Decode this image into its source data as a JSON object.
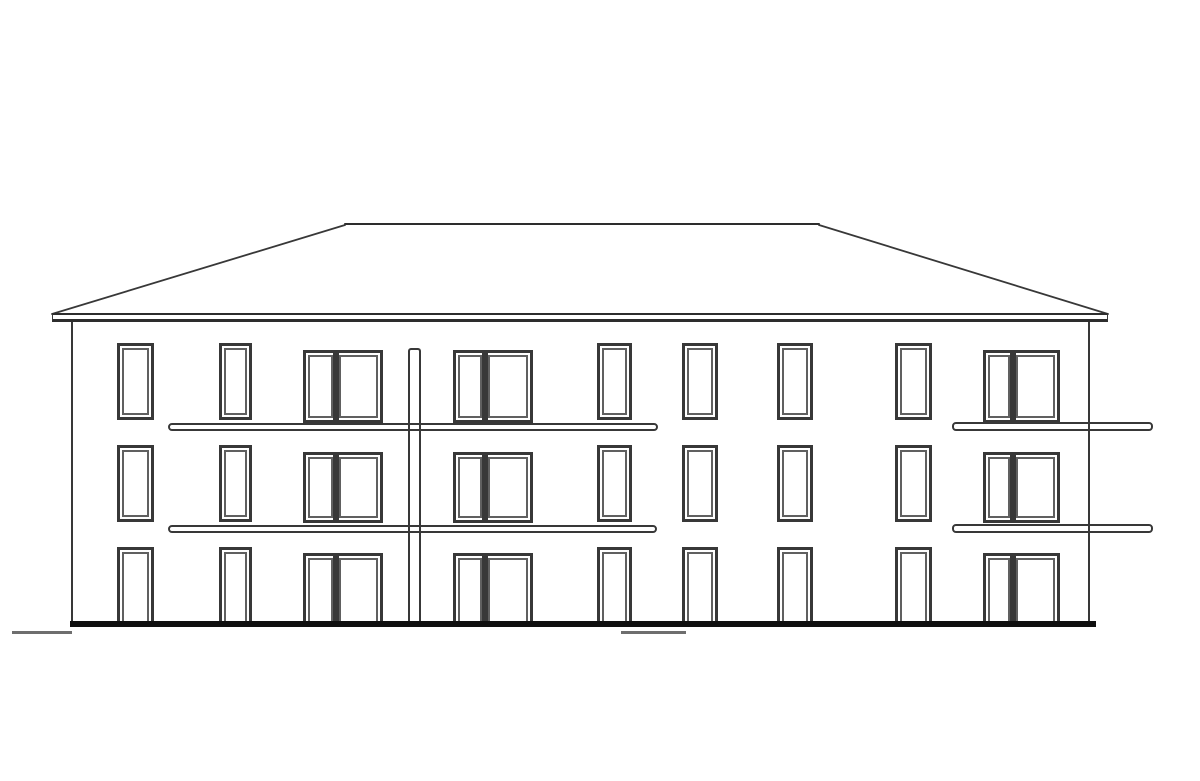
{
  "meta": {
    "description": "architectural-front-elevation-line-drawing",
    "floors": 3,
    "window_column_count": 9
  },
  "palette": {
    "background": "#ffffff",
    "line": "#383838",
    "line_light": "#606060",
    "roof_line": "#2d2d2d",
    "ground": "#0f0f0f",
    "ground_mark": "#6e6e6e",
    "fill": "#ffffff"
  },
  "drawing": {
    "canvas": {
      "w": 1200,
      "h": 781
    },
    "roof": {
      "ridge": {
        "x1": 345,
        "y1": 224,
        "x2": 819,
        "y2": 224
      },
      "hip_left": {
        "x1": 345,
        "y1": 225,
        "x2": 52,
        "y2": 314
      },
      "hip_right": {
        "x1": 819,
        "y1": 225,
        "x2": 1108,
        "y2": 314
      },
      "eaves_band": {
        "x": 52,
        "y": 313,
        "w": 1056,
        "h": 9
      }
    },
    "walls": {
      "left_x": 71,
      "right_x": 1088,
      "top_y": 322,
      "height": 300,
      "stroke": 2
    },
    "ground": {
      "x": 70,
      "y": 621,
      "w": 1026,
      "h": 6
    },
    "ground_marks": [
      {
        "x": 12,
        "y": 631,
        "w": 60,
        "h": 3
      },
      {
        "x": 621,
        "y": 631,
        "w": 65,
        "h": 3
      }
    ],
    "downpipe": {
      "x": 408,
      "y": 348,
      "w": 13,
      "h": 274
    },
    "balcony_slabs": [
      {
        "x": 168,
        "y": 423,
        "w": 490,
        "h": 8
      },
      {
        "x": 952,
        "y": 422,
        "w": 201,
        "h": 9
      },
      {
        "x": 168,
        "y": 525,
        "w": 489,
        "h": 8
      },
      {
        "x": 952,
        "y": 524,
        "w": 201,
        "h": 9
      }
    ],
    "columns": [
      {
        "kind": "single",
        "x": 117,
        "w": 37
      },
      {
        "kind": "single",
        "x": 219,
        "w": 33
      },
      {
        "kind": "double",
        "x": 303,
        "w": 80,
        "lp": 27
      },
      {
        "kind": "double",
        "x": 453,
        "w": 80,
        "lp": 26
      },
      {
        "kind": "single",
        "x": 597,
        "w": 35
      },
      {
        "kind": "single",
        "x": 682,
        "w": 36
      },
      {
        "kind": "single",
        "x": 777,
        "w": 36
      },
      {
        "kind": "single",
        "x": 895,
        "w": 37
      },
      {
        "kind": "double",
        "x": 983,
        "w": 77,
        "lp": 24
      }
    ],
    "floors": {
      "single_rows": [
        {
          "y": 343,
          "h": 77,
          "open_bottom": false
        },
        {
          "y": 445,
          "h": 77,
          "open_bottom": false
        },
        {
          "y": 547,
          "h": 76,
          "open_bottom": true
        }
      ],
      "double_rows": [
        {
          "y": 350,
          "h": 73,
          "open_bottom": false
        },
        {
          "y": 452,
          "h": 71,
          "open_bottom": false
        },
        {
          "y": 553,
          "h": 70,
          "open_bottom": true
        }
      ]
    }
  }
}
